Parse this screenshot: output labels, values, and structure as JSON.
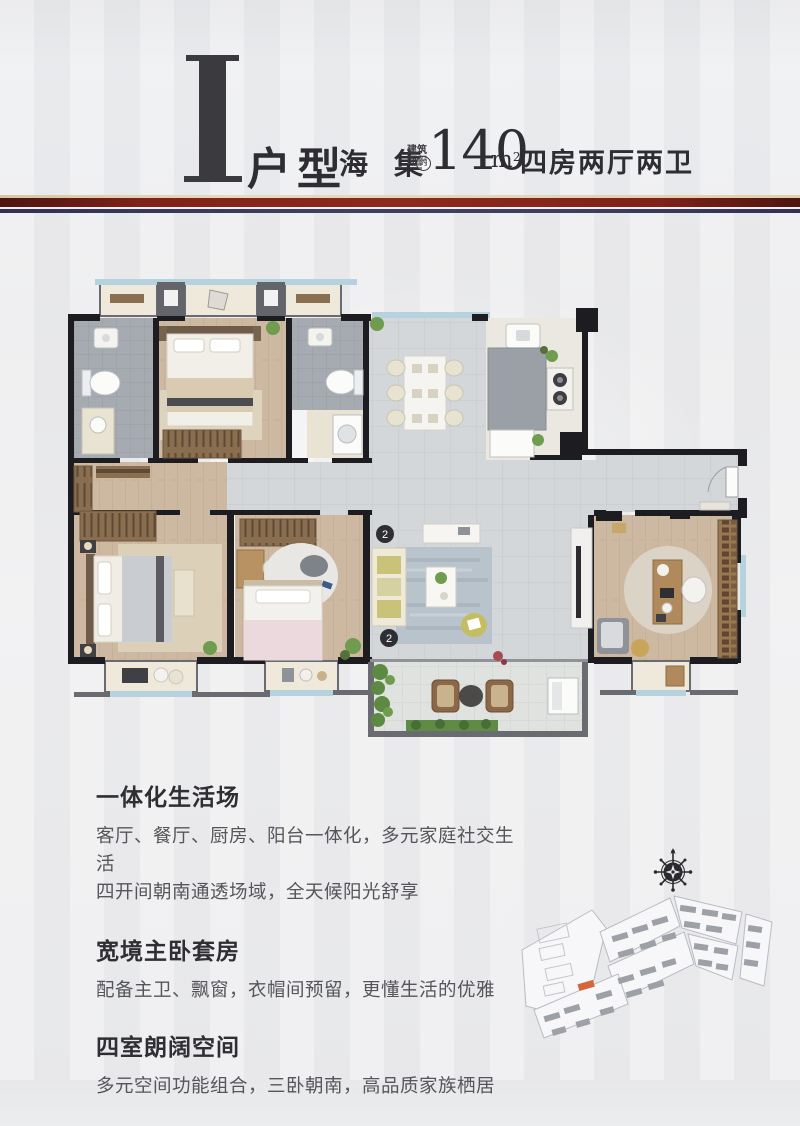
{
  "header": {
    "plan_letter": "I",
    "plan_type": "户型",
    "project_name": "海 集",
    "area_label_line1": "建筑",
    "area_label_line2": "面积",
    "area_approx": "约",
    "area_value": "140",
    "area_unit": "m",
    "area_unit_exp": "2",
    "spec": "四房两厅两卫"
  },
  "floorplan": {
    "marker_top": "2",
    "marker_bottom": "2"
  },
  "features": [
    {
      "title": "一体化生活场",
      "lines": [
        "客厅、餐厅、厨房、阳台一体化，多元家庭社交生活",
        "四开间朝南通透场域，全天候阳光舒享"
      ]
    },
    {
      "title": "宽境主卧套房",
      "lines": [
        "配备主卫、飘窗，衣帽间预留，更懂生活的优雅"
      ]
    },
    {
      "title": "四室朗阔空间",
      "lines": [
        "多元空间功能组合，三卧朝南，高品质家族栖居"
      ]
    }
  ],
  "colors": {
    "divider_red": "#80221a",
    "divider_navy": "#3a4066",
    "wall": "#1d1d21",
    "wood_floor": "#cdb9a2",
    "tile_floor": "#d4d7da",
    "bath_floor": "#a6abb2",
    "window_glass": "#b5d2de",
    "highlight_building": "#d4663a"
  }
}
